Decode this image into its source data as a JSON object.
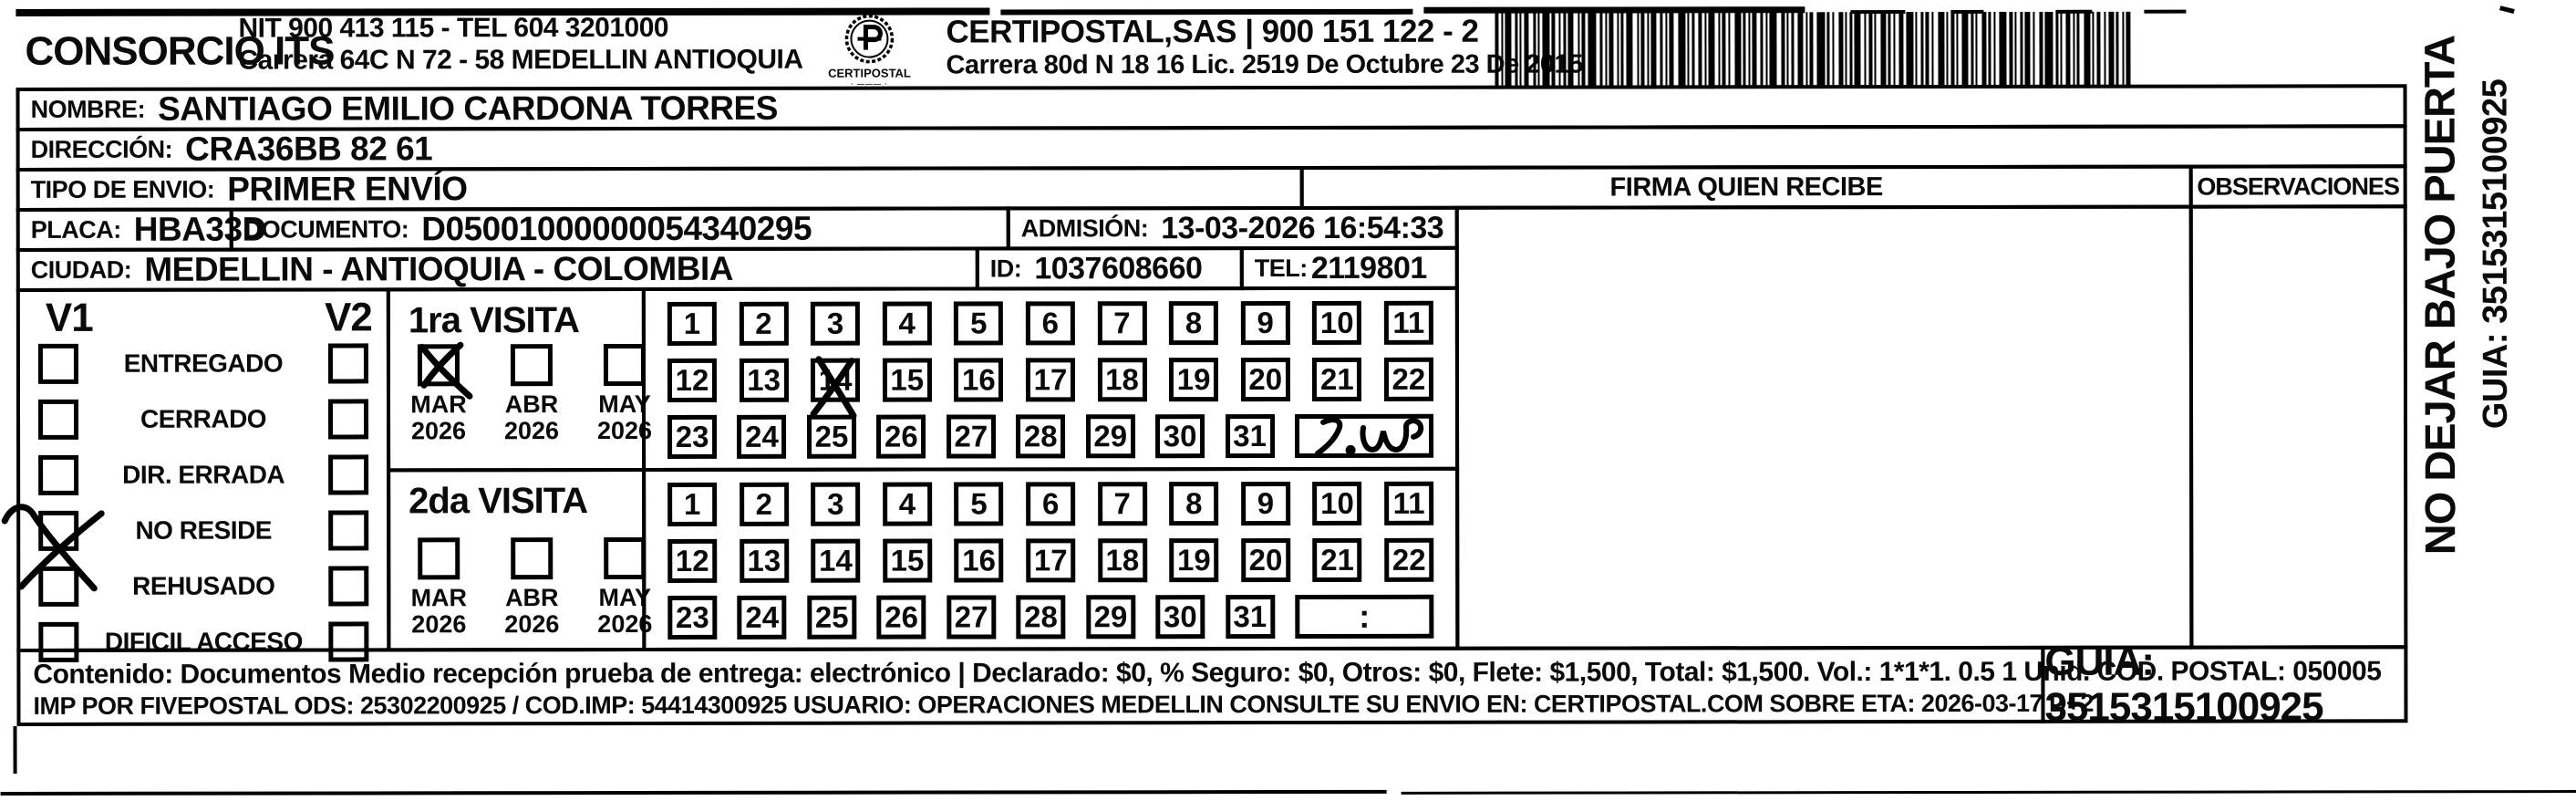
{
  "header": {
    "company": "CONSORCIO ITS",
    "nit_line": "NIT 900 413 115 - TEL 604 3201000",
    "address_line": "Carrera 64C N 72 - 58 MEDELLIN ANTIOQUIA",
    "logo_caption": "CERTIPOSTAL",
    "carrier_line": "CERTIPOSTAL,SAS | 900 151 122 - 2",
    "carrier_address": "Carrera 80d N 18 16  Lic. 2519 De Octubre 23 De 2015"
  },
  "fields": {
    "nombre": {
      "label": "NOMBRE:",
      "value": "SANTIAGO EMILIO CARDONA TORRES"
    },
    "direccion": {
      "label": "DIRECCIÓN:",
      "value": "CRA36BB 82 61"
    },
    "tipo": {
      "label": "TIPO DE ENVIO:",
      "value": "PRIMER ENVÍO"
    },
    "placa": {
      "label": "PLACA:",
      "value": "HBA33D"
    },
    "documento": {
      "label": "DOCUMENTO:",
      "value": "D05001000000054340295"
    },
    "admision": {
      "label": "ADMISIÓN:",
      "value": "13-03-2026 16:54:33"
    },
    "ciudad": {
      "label": "CIUDAD:",
      "value": "MEDELLIN - ANTIOQUIA - COLOMBIA"
    },
    "id": {
      "label": "ID:",
      "value": "1037608660"
    },
    "tel": {
      "label": "TEL:",
      "value": "2119801"
    }
  },
  "columns": {
    "firma_header": "FIRMA QUIEN RECIBE",
    "observaciones_header": "OBSERVACIONES"
  },
  "status": {
    "col1": "V1",
    "col2": "V2",
    "items": [
      {
        "label": "ENTREGADO",
        "v1_checked": false,
        "v2_checked": false
      },
      {
        "label": "CERRADO",
        "v1_checked": false,
        "v2_checked": false
      },
      {
        "label": "DIR. ERRADA",
        "v1_checked": false,
        "v2_checked": false
      },
      {
        "label": "NO RESIDE",
        "v1_checked": true,
        "v2_checked": false
      },
      {
        "label": "REHUSADO",
        "v1_checked": false,
        "v2_checked": false
      },
      {
        "label": "DIFICIL ACCESO",
        "v1_checked": false,
        "v2_checked": false
      }
    ]
  },
  "visits": [
    {
      "title": "1ra VISITA",
      "months": [
        {
          "label": "MAR",
          "year": "2026",
          "checked": true
        },
        {
          "label": "ABR",
          "year": "2026",
          "checked": false
        },
        {
          "label": "MAY",
          "year": "2026",
          "checked": false
        }
      ],
      "day_rows": [
        [
          1,
          2,
          3,
          4,
          5,
          6,
          7,
          8,
          9,
          10,
          11
        ],
        [
          12,
          13,
          14,
          15,
          16,
          17,
          18,
          19,
          20,
          21,
          22
        ],
        [
          23,
          24,
          25,
          26,
          27,
          28,
          29,
          30,
          31
        ]
      ],
      "crossed_day": 14,
      "extra_box": "handwriting"
    },
    {
      "title": "2da VISITA",
      "months": [
        {
          "label": "MAR",
          "year": "2026",
          "checked": false
        },
        {
          "label": "ABR",
          "year": "2026",
          "checked": false
        },
        {
          "label": "MAY",
          "year": "2026",
          "checked": false
        }
      ],
      "day_rows": [
        [
          1,
          2,
          3,
          4,
          5,
          6,
          7,
          8,
          9,
          10,
          11
        ],
        [
          12,
          13,
          14,
          15,
          16,
          17,
          18,
          19,
          20,
          21,
          22
        ],
        [
          23,
          24,
          25,
          26,
          27,
          28,
          29,
          30,
          31
        ]
      ],
      "crossed_day": null,
      "extra_box_text": ":"
    }
  ],
  "footer": {
    "line1": "Contenido: Documentos Medio recepción prueba de entrega: electrónico | Declarado: $0, % Seguro: $0, Otros: $0, Flete: $1,500, Total: $1,500. Vol.: 1*1*1. 0.5  1 Unid. COD. POSTAL: 050005",
    "line2": "IMP POR FIVEPOSTAL ODS: 25302200925 / COD.IMP: 54414300925 USUARIO: OPERACIONES MEDELLIN CONSULTE SU ENVIO EN: CERTIPOSTAL.COM SOBRE ETA: 2026-03-17 D+2",
    "guia": "GUIA: 3515315100925"
  },
  "side": {
    "warning": "NO DEJAR BAJO PUERTA",
    "guia": "GUIA: 3515315100925"
  }
}
